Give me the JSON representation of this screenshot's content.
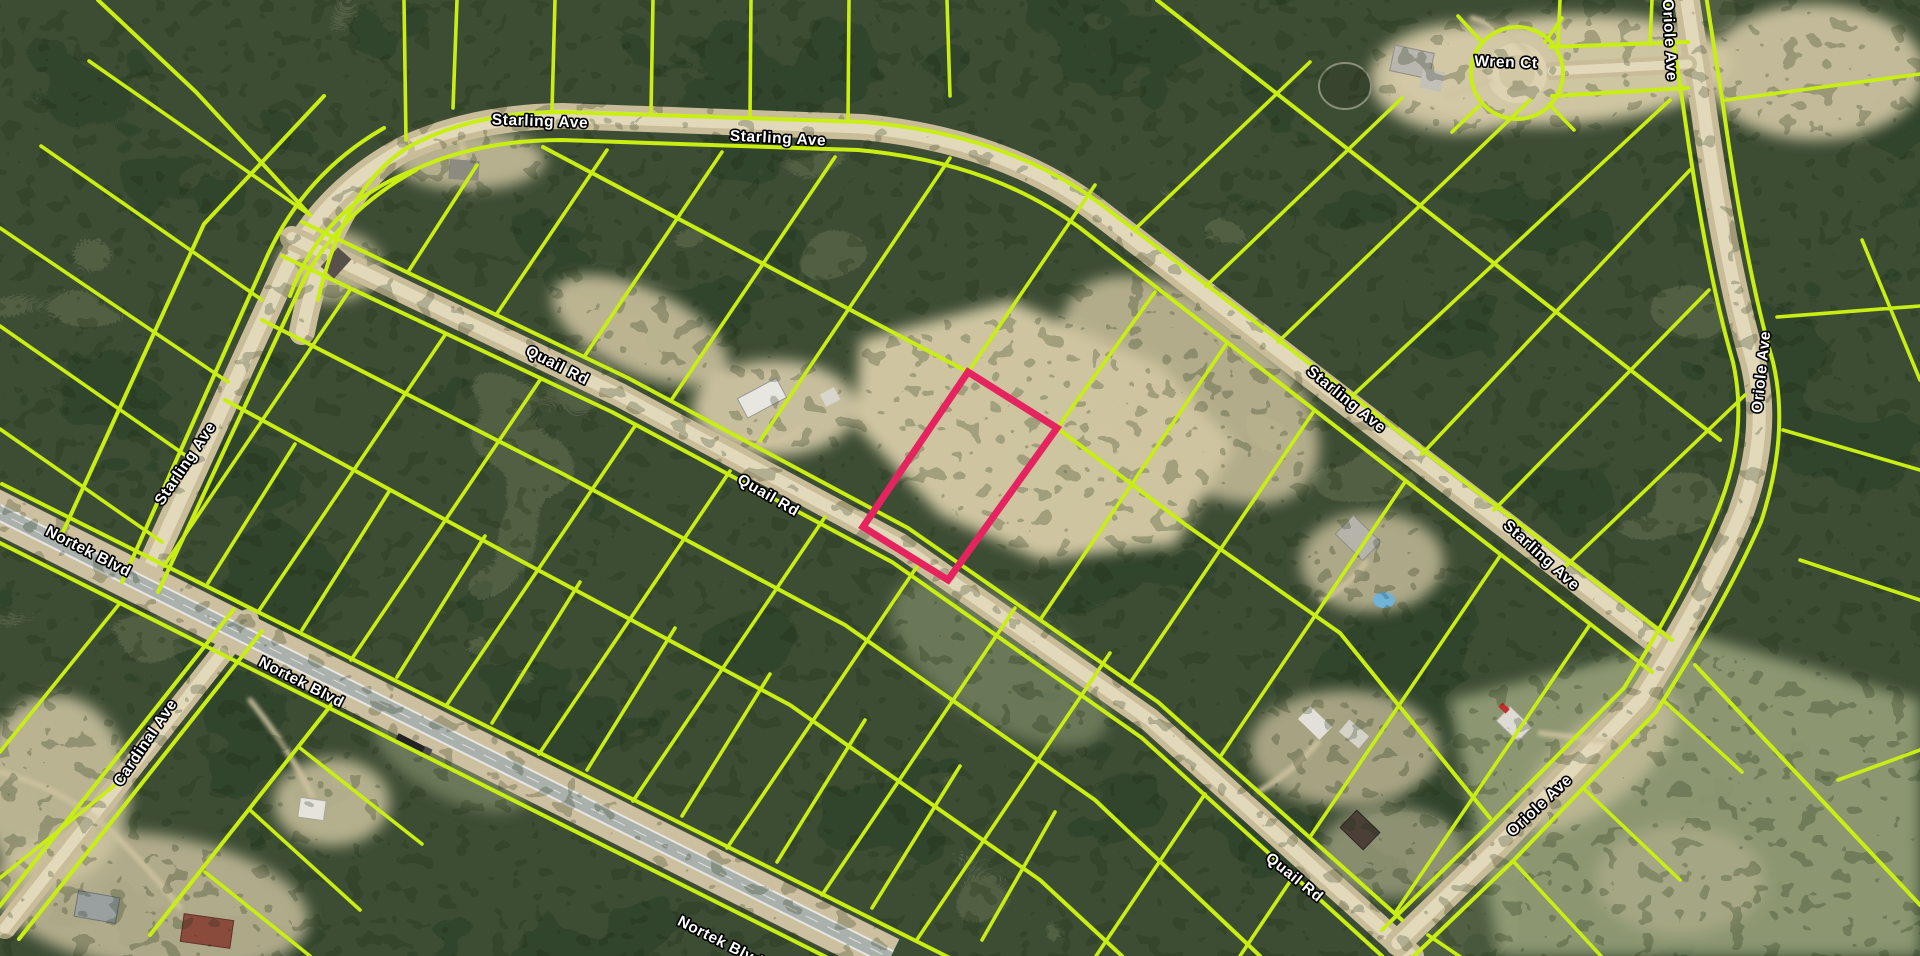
{
  "map": {
    "description": "Aerial parcel map with lot boundary overlay and highlighted lot on Quail Rd",
    "colors": {
      "parcel_line": "#c8ee14",
      "highlight": "#e5245f",
      "label_fill": "#ffffff",
      "label_outline": "#000000",
      "forest_base": "#3d4d34",
      "sand": "#d6cba8",
      "paved_road": "#abb1ac",
      "dirt_road": "#e2d8ba",
      "pool_water": "#6fb3d8"
    },
    "road_labels": [
      {
        "text": "Starling Ave",
        "x": 540,
        "y": 122,
        "rot": 2
      },
      {
        "text": "Starling Ave",
        "x": 778,
        "y": 139,
        "rot": 3
      },
      {
        "text": "Starling Ave",
        "x": 186,
        "y": 464,
        "rot": -56
      },
      {
        "text": "Starling Ave",
        "x": 1346,
        "y": 400,
        "rot": 39
      },
      {
        "text": "Starling Ave",
        "x": 1541,
        "y": 556,
        "rot": 42
      },
      {
        "text": "Wren Ct",
        "x": 1506,
        "y": 63,
        "rot": 2
      },
      {
        "text": "Oriole Ave",
        "x": 1669,
        "y": 40,
        "rot": 87
      },
      {
        "text": "Oriole Ave",
        "x": 1762,
        "y": 372,
        "rot": -84
      },
      {
        "text": "Oriole Ave",
        "x": 1540,
        "y": 806,
        "rot": -43
      },
      {
        "text": "Quail Rd",
        "x": 557,
        "y": 366,
        "rot": 27
      },
      {
        "text": "Quail Rd",
        "x": 768,
        "y": 496,
        "rot": 30
      },
      {
        "text": "Quail Rd",
        "x": 1294,
        "y": 878,
        "rot": 39
      },
      {
        "text": "Nortek Blvd",
        "x": 88,
        "y": 552,
        "rot": 27
      },
      {
        "text": "Nortek Blvd",
        "x": 301,
        "y": 683,
        "rot": 27
      },
      {
        "text": "Nortek Blvd",
        "x": 720,
        "y": 942,
        "rot": 27
      },
      {
        "text": "Cardinal Ave",
        "x": 146,
        "y": 743,
        "rot": -56
      }
    ],
    "highlighted_parcel": {
      "points": "968,372 1057,428 948,580 863,527",
      "stroke": "#e5245f",
      "stroke_width": 7,
      "fronts_on": "Quail Rd"
    }
  }
}
